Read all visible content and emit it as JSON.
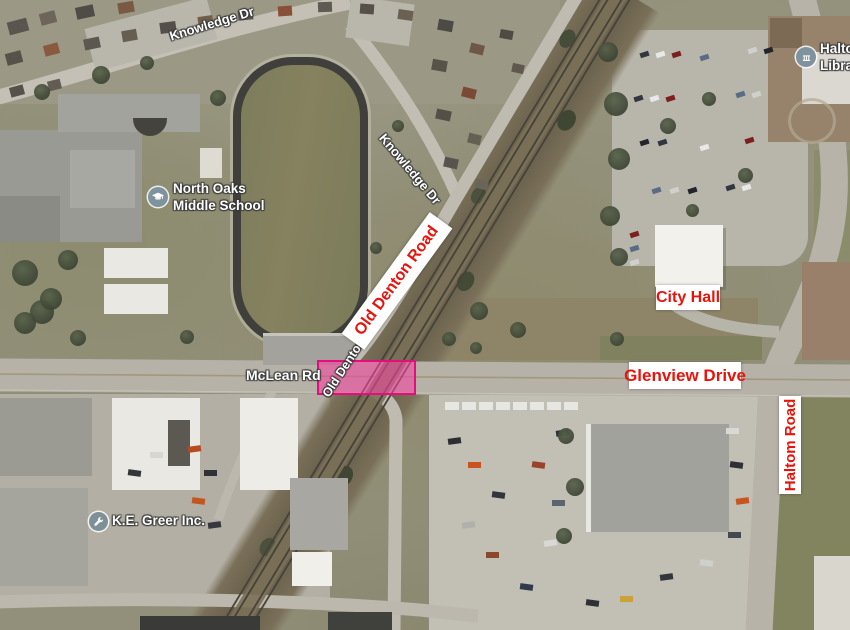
{
  "map_annotations": {
    "old_denton_road": "Old Denton Road",
    "glenview_drive": "Glenview Drive",
    "city_hall": "City Hall",
    "haltom_road": "Haltom Road"
  },
  "street_labels": {
    "knowledge_dr_top": "Knowledge Dr",
    "knowledge_dr_mid": "Knowledge Dr",
    "mclean_rd": "McLean Rd",
    "old_denton_st": "Old Denton Rd"
  },
  "poi_labels": {
    "school": {
      "line1": "North Oaks",
      "line2": "Middle School",
      "icon": "graduation-cap-icon"
    },
    "business": {
      "name": "K.E. Greer Inc.",
      "icon": "wrench-icon"
    },
    "library": {
      "line1": "Haltom",
      "line2": "Library",
      "icon": "library-icon"
    }
  },
  "highlight": {
    "fill": "#f0469e",
    "border": "#e60d7c"
  },
  "colors": {
    "annotation_text": "#e8130b",
    "annotation_bg": "#ffffff"
  }
}
